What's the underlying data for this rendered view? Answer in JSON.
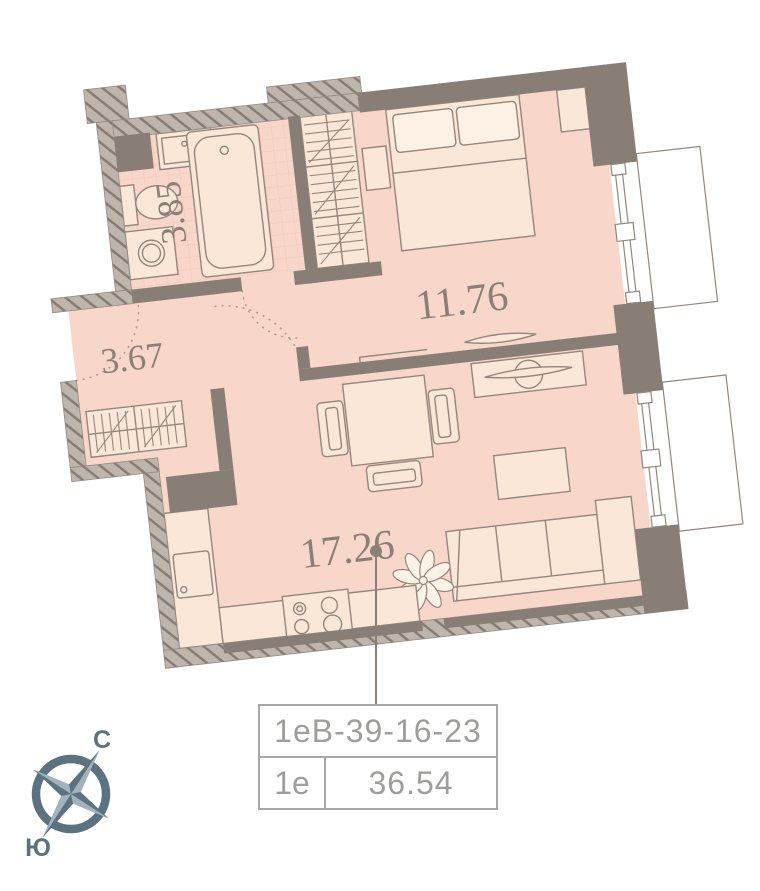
{
  "floor_plan": {
    "rooms": [
      {
        "id": "bathroom",
        "area": "3.85"
      },
      {
        "id": "bedroom",
        "area": "11.76"
      },
      {
        "id": "hallway",
        "area": "3.67"
      },
      {
        "id": "living-kitchen",
        "area": "17.26"
      }
    ],
    "unit_card": {
      "code": "1еВ-39-16-23",
      "type": "1е",
      "total_area": "36.54"
    },
    "compass": {
      "north_label": "С",
      "south_label": "Ю"
    },
    "colors": {
      "floor": "#f8d6ca",
      "furniture_fill": "#fbe7d8",
      "furniture_line": "#94867c",
      "wall_solid": "#897e76",
      "wall_hatch_base": "#beb5ac",
      "tile_line": "#f1c9ba",
      "area_text": "#8b8076",
      "card_text": "#9e9e9c",
      "card_border": "#a7a7a5",
      "compass": "#5b7280",
      "leader": "#8a8078"
    }
  }
}
